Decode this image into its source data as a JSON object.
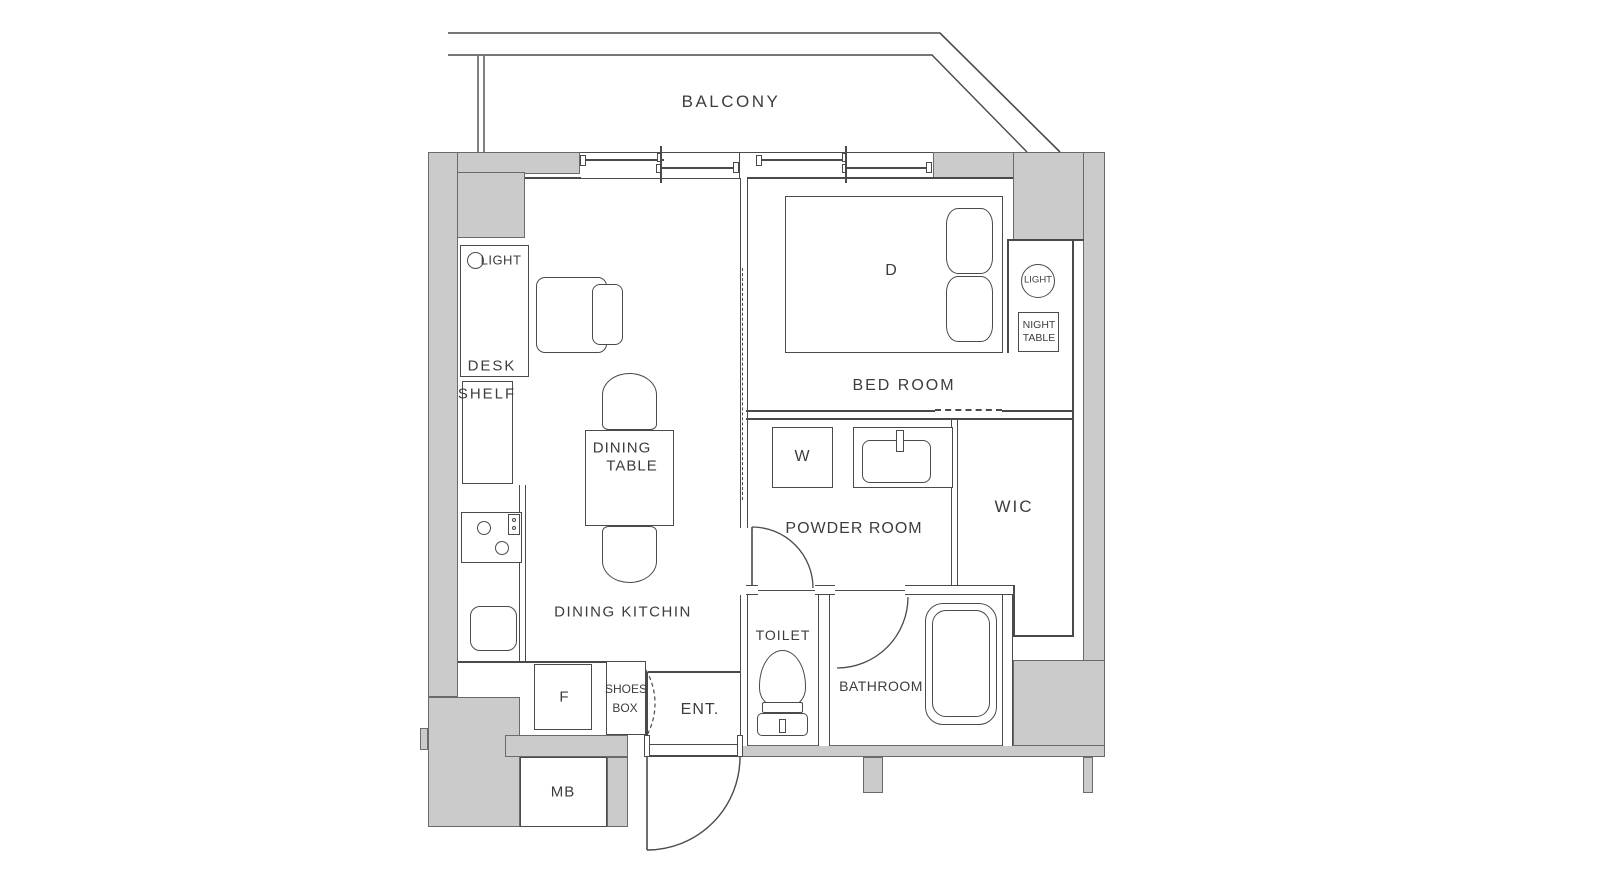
{
  "colors": {
    "background": "#ffffff",
    "wall_fill": "#cbcbcb",
    "line": "#4a4a4a",
    "text": "#3d3d3d"
  },
  "areas": {
    "balcony": {
      "label": "BALCONY"
    },
    "dining_kitchen": {
      "label": "DINING KITCHIN",
      "desk": "DESK",
      "desk_light": "LIGHT",
      "shelf": "SHELF",
      "dining_table_line1": "DINING",
      "dining_table_line2": "TABLE",
      "fridge": "F"
    },
    "entrance": {
      "label": "ENT.",
      "shoes_box_line1": "SHOES",
      "shoes_box_line2": "BOX",
      "meter_box": "MB"
    },
    "bedroom": {
      "label": "BED ROOM",
      "bed_size": "D",
      "light": "LIGHT",
      "night_table_line1": "NIGHT",
      "night_table_line2": "TABLE"
    },
    "powder_room": {
      "label": "POWDER ROOM",
      "washer": "W"
    },
    "wic": {
      "label": "WIC"
    },
    "toilet": {
      "label": "TOILET"
    },
    "bathroom": {
      "label": "BATHROOM"
    }
  }
}
